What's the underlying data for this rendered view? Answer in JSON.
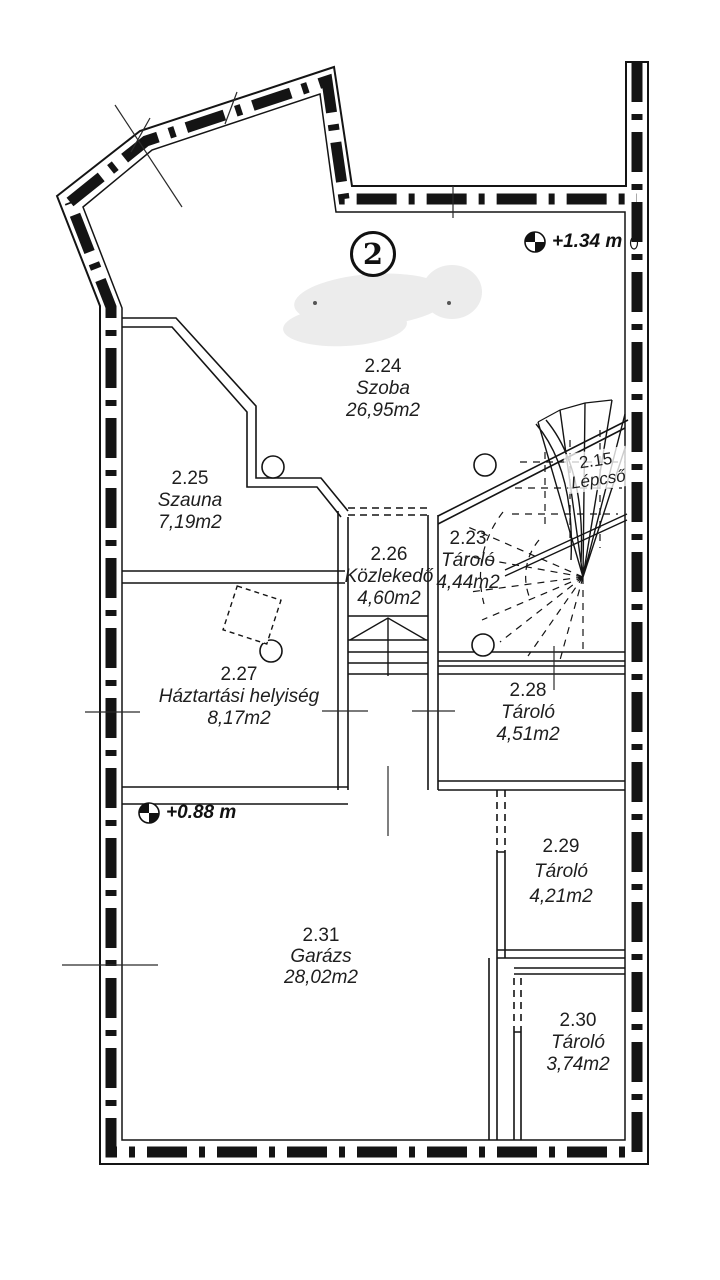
{
  "plan": {
    "badge": "2",
    "level_markers": [
      {
        "label": "+1.34 m"
      },
      {
        "label": "+0.88 m"
      }
    ],
    "rooms": [
      {
        "number": "2.24",
        "name": "Szoba",
        "area": "26,95m2"
      },
      {
        "number": "2.25",
        "name": "Szauna",
        "area": "7,19m2"
      },
      {
        "number": "2.15",
        "name": "Lépcső",
        "area": ""
      },
      {
        "number": "2.23",
        "name": "Tároló",
        "area": "4,44m2"
      },
      {
        "number": "2.26",
        "name": "Közlekedő",
        "area": "4,60m2"
      },
      {
        "number": "2.27",
        "name": "Háztartási helyiség",
        "area": "8,17m2"
      },
      {
        "number": "2.28",
        "name": "Tároló",
        "area": "4,51m2"
      },
      {
        "number": "2.29",
        "name": "Tároló",
        "area": "4,21m2"
      },
      {
        "number": "2.30",
        "name": "Tároló",
        "area": "3,74m2"
      },
      {
        "number": "2.31",
        "name": "Garázs",
        "area": "28,02m2"
      }
    ]
  }
}
